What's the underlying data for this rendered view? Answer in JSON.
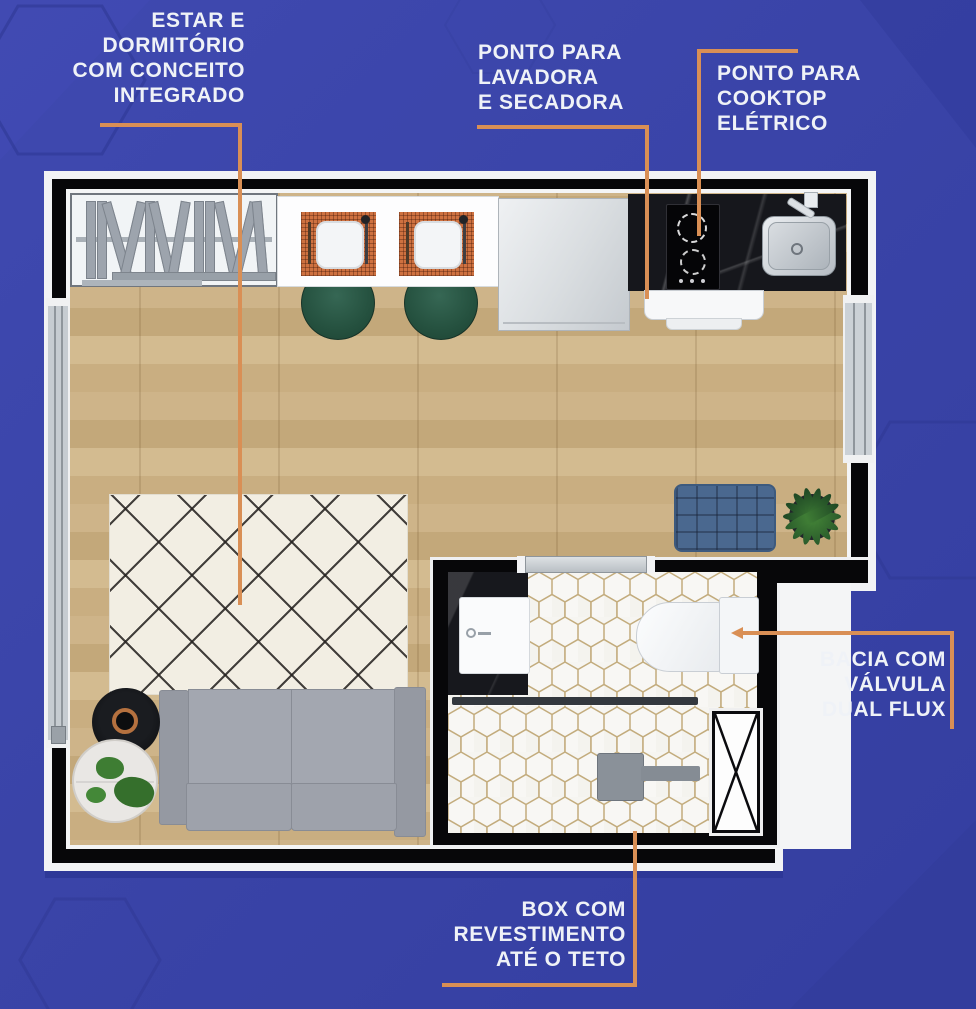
{
  "annotations": {
    "living_area": {
      "text": "ESTAR E\nDORMITÓRIO\nCOM CONCEITO\nINTEGRADO"
    },
    "washer_dryer": {
      "text": "PONTO PARA\nLAVADORA\nE SECADORA"
    },
    "cooktop": {
      "text": "PONTO PARA\nCOOKTOP\nELÉTRICO"
    },
    "toilet": {
      "text": "BACIA COM\nVÁLVULA\nDUAL FLUX"
    },
    "shower": {
      "text": "BOX COM\nREVESTIMENTO\nATÉ O TETO"
    }
  },
  "colors": {
    "accent": "#D98F55",
    "background": "#3A44A8",
    "wall": "#070709",
    "wood_floor": "#CDB388",
    "rug": "#F2EEE3",
    "sofa": "#9EA3AC",
    "stool_green": "#25513F",
    "ottoman_blue": "#4A688F",
    "placemat_orange": "#C96F3F",
    "tile_grout": "#C3AC7D",
    "label_text": "#EFF2F7"
  },
  "floorplan": {
    "type": "studio-apartment-top-view",
    "fixtures": [
      "bookshelf",
      "dining-counter",
      "bar-stools",
      "fridge",
      "kitchen-countertop",
      "cooktop",
      "kitchen-sink",
      "washer-dryer-point",
      "area-rug",
      "sofa",
      "side-table",
      "tray-table",
      "ottoman",
      "potted-plant",
      "vanity",
      "bathroom-sink",
      "toilet",
      "bathroom-door",
      "shower-glass-partition",
      "shower-head",
      "shaft",
      "window-left",
      "window-right"
    ]
  }
}
